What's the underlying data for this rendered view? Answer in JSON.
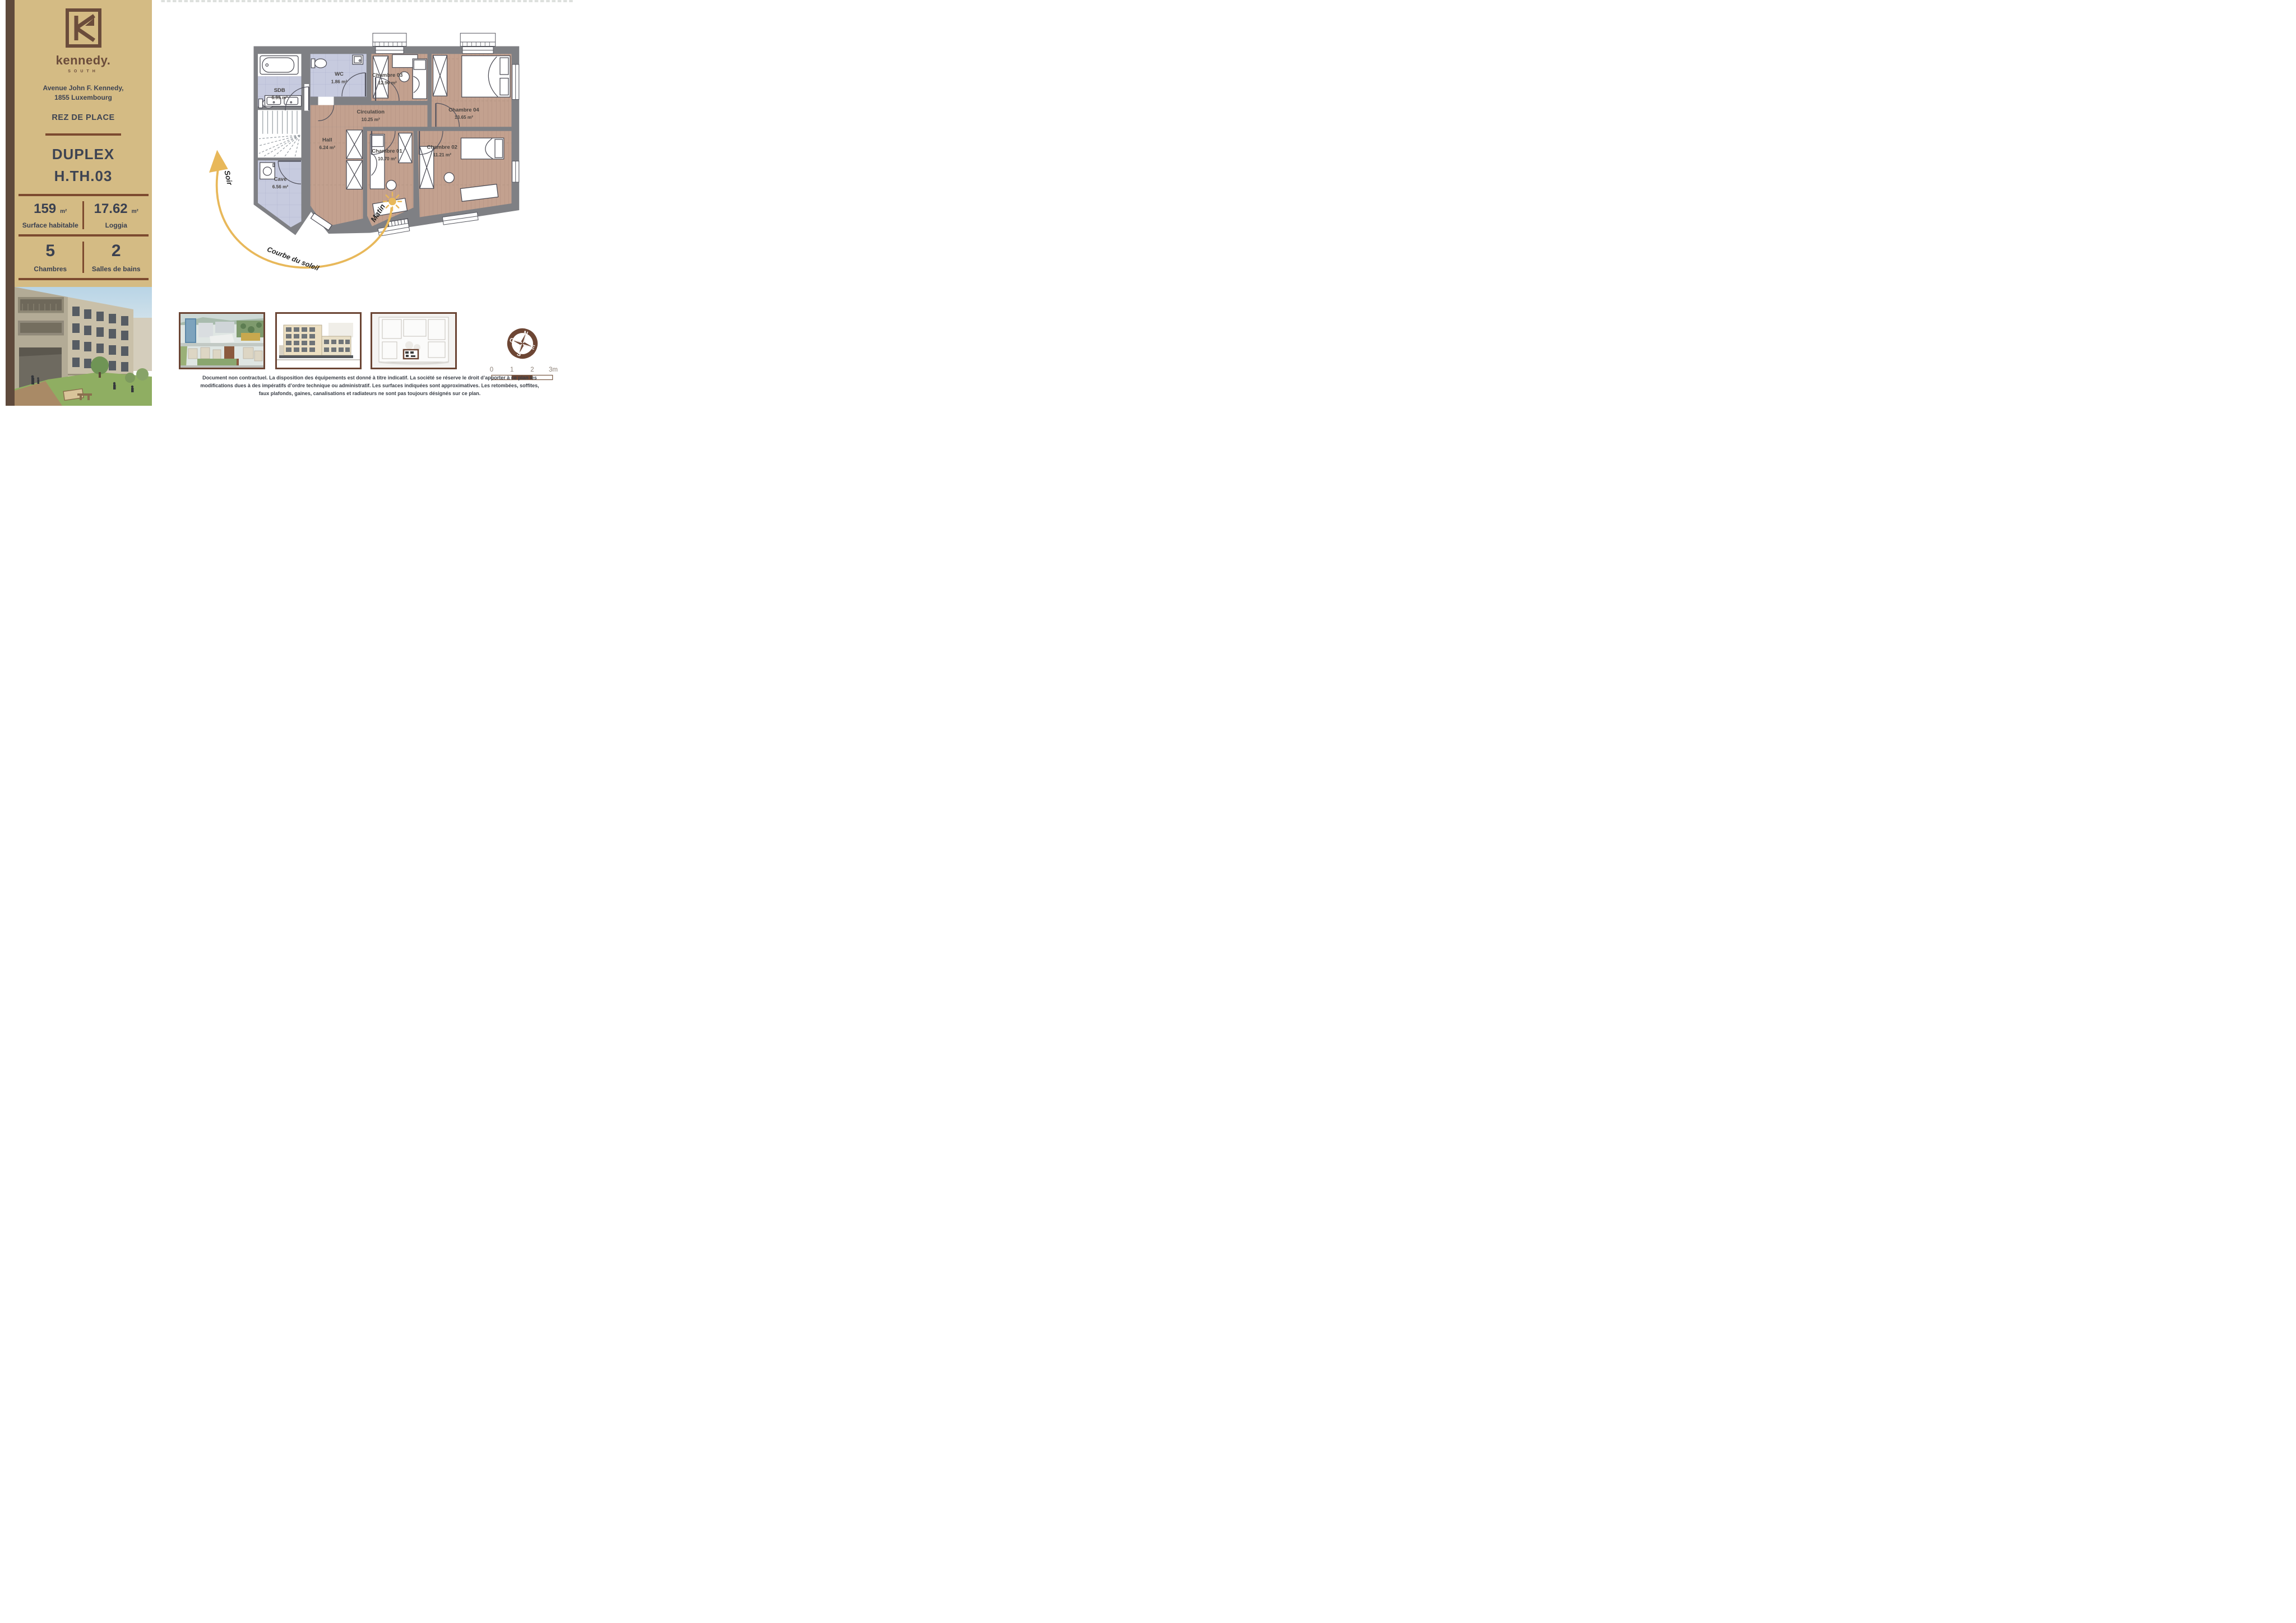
{
  "brand": {
    "wordmark": "kennedy.",
    "subtitle": "SOUTH"
  },
  "sidebar": {
    "address_line1": "Avenue John F. Kennedy,",
    "address_line2": "1855 Luxembourg",
    "floor_label": "REZ DE PLACE",
    "unit_type": "DUPLEX",
    "unit_code": "H.TH.03",
    "stats": {
      "surface_value": "159",
      "surface_unit": "m²",
      "surface_label": "Surface habitable",
      "loggia_value": "17.62",
      "loggia_unit": "m²",
      "loggia_label": "Loggia",
      "bedrooms_value": "5",
      "bedrooms_label": "Chambres",
      "baths_value": "2",
      "baths_label": "Salles de bains"
    }
  },
  "plan": {
    "rooms": {
      "sdb": {
        "name": "SDB",
        "area": "6.99 m²"
      },
      "wc": {
        "name": "WC",
        "area": "1.86 m²"
      },
      "ch03": {
        "name": "Chambre 03",
        "area": "12.90 m²"
      },
      "ch04": {
        "name": "Chambre 04",
        "area": "13.65 m²"
      },
      "circulation": {
        "name": "Circulation",
        "area": "10.25 m²"
      },
      "hall": {
        "name": "Hall",
        "area": "6.24 m²"
      },
      "ch01": {
        "name": "Chambre 01",
        "area": "10.70 m²"
      },
      "ch02": {
        "name": "Chambre 02",
        "area": "11.21 m²"
      },
      "cave": {
        "name": "Cave",
        "area": "6.56 m²"
      }
    },
    "sun": {
      "evening": "Soir",
      "morning": "Matin",
      "curve_label": "Courbe du soleil"
    },
    "compass": {
      "north": "N",
      "east": "E",
      "south": "S",
      "west": "O"
    },
    "scalebar": {
      "t0": "0",
      "t1": "1",
      "t2": "2",
      "t3": "3m"
    }
  },
  "footer": {
    "disclaimer_line1": "Document non contractuel. La disposition des équipements est donné à titre indicatif. La société se réserve le droit d’apporter à ce plan les",
    "disclaimer_line2": "modifications dues à des impératifs d’ordre technique ou administratif. Les surfaces indiquées sont approximatives. Les retombées, soffites,",
    "disclaimer_line3": "faux plafonds, gaines, canalisations et radiateurs ne sont pas toujours désignés sur ce plan."
  },
  "colors": {
    "sidebar_tan": "#d4bb84",
    "brand_brown": "#6b4c3b",
    "accent_brown": "#7c4a2f",
    "frame_brown": "#6b4534",
    "heading_slate": "#3d4352",
    "wall_gray": "#7f8084",
    "wood_floor": "#c3a18f",
    "tile_floor": "#c7cbdf",
    "sun_gold": "#e8b85a"
  }
}
